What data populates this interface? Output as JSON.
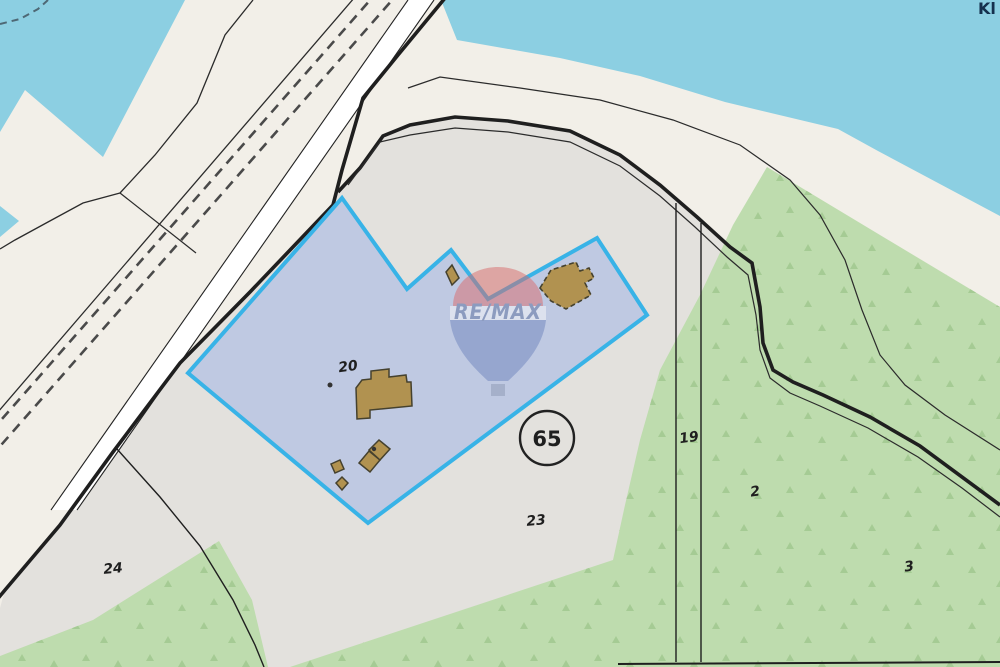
{
  "map": {
    "type": "cadastral-parcel-map",
    "labels": {
      "p20": "20",
      "p24": "24",
      "p23": "23",
      "p19": "19",
      "p2": "2",
      "p3": "3",
      "p65": "65",
      "corner": "Kl"
    },
    "watermark": {
      "brand": "RE/MAX"
    }
  },
  "colors": {
    "water": "#8ccfe2",
    "land": "#f2efe8",
    "parcel_area": "#e3e1dd",
    "forest": "#bedcae",
    "tree": "#a5cb94",
    "highlight_fill": "#b5c3e3",
    "highlight_border": "#38b3e7",
    "building": "#b19250",
    "building_outline": "#45412e",
    "road_white": "#ffffff",
    "line_dark": "#1f1f1f",
    "railway_dash": "#4a4a4a",
    "balloon_red": "#d96b6b",
    "balloon_blue": "#6e84bd",
    "balloon_band": "#fafafa",
    "basket": "#8d99b4",
    "watermark_text": "#5a6f9e",
    "label": "#1f1f1f",
    "corner_label": "#14304d",
    "shore_dash": "#4e6875"
  }
}
